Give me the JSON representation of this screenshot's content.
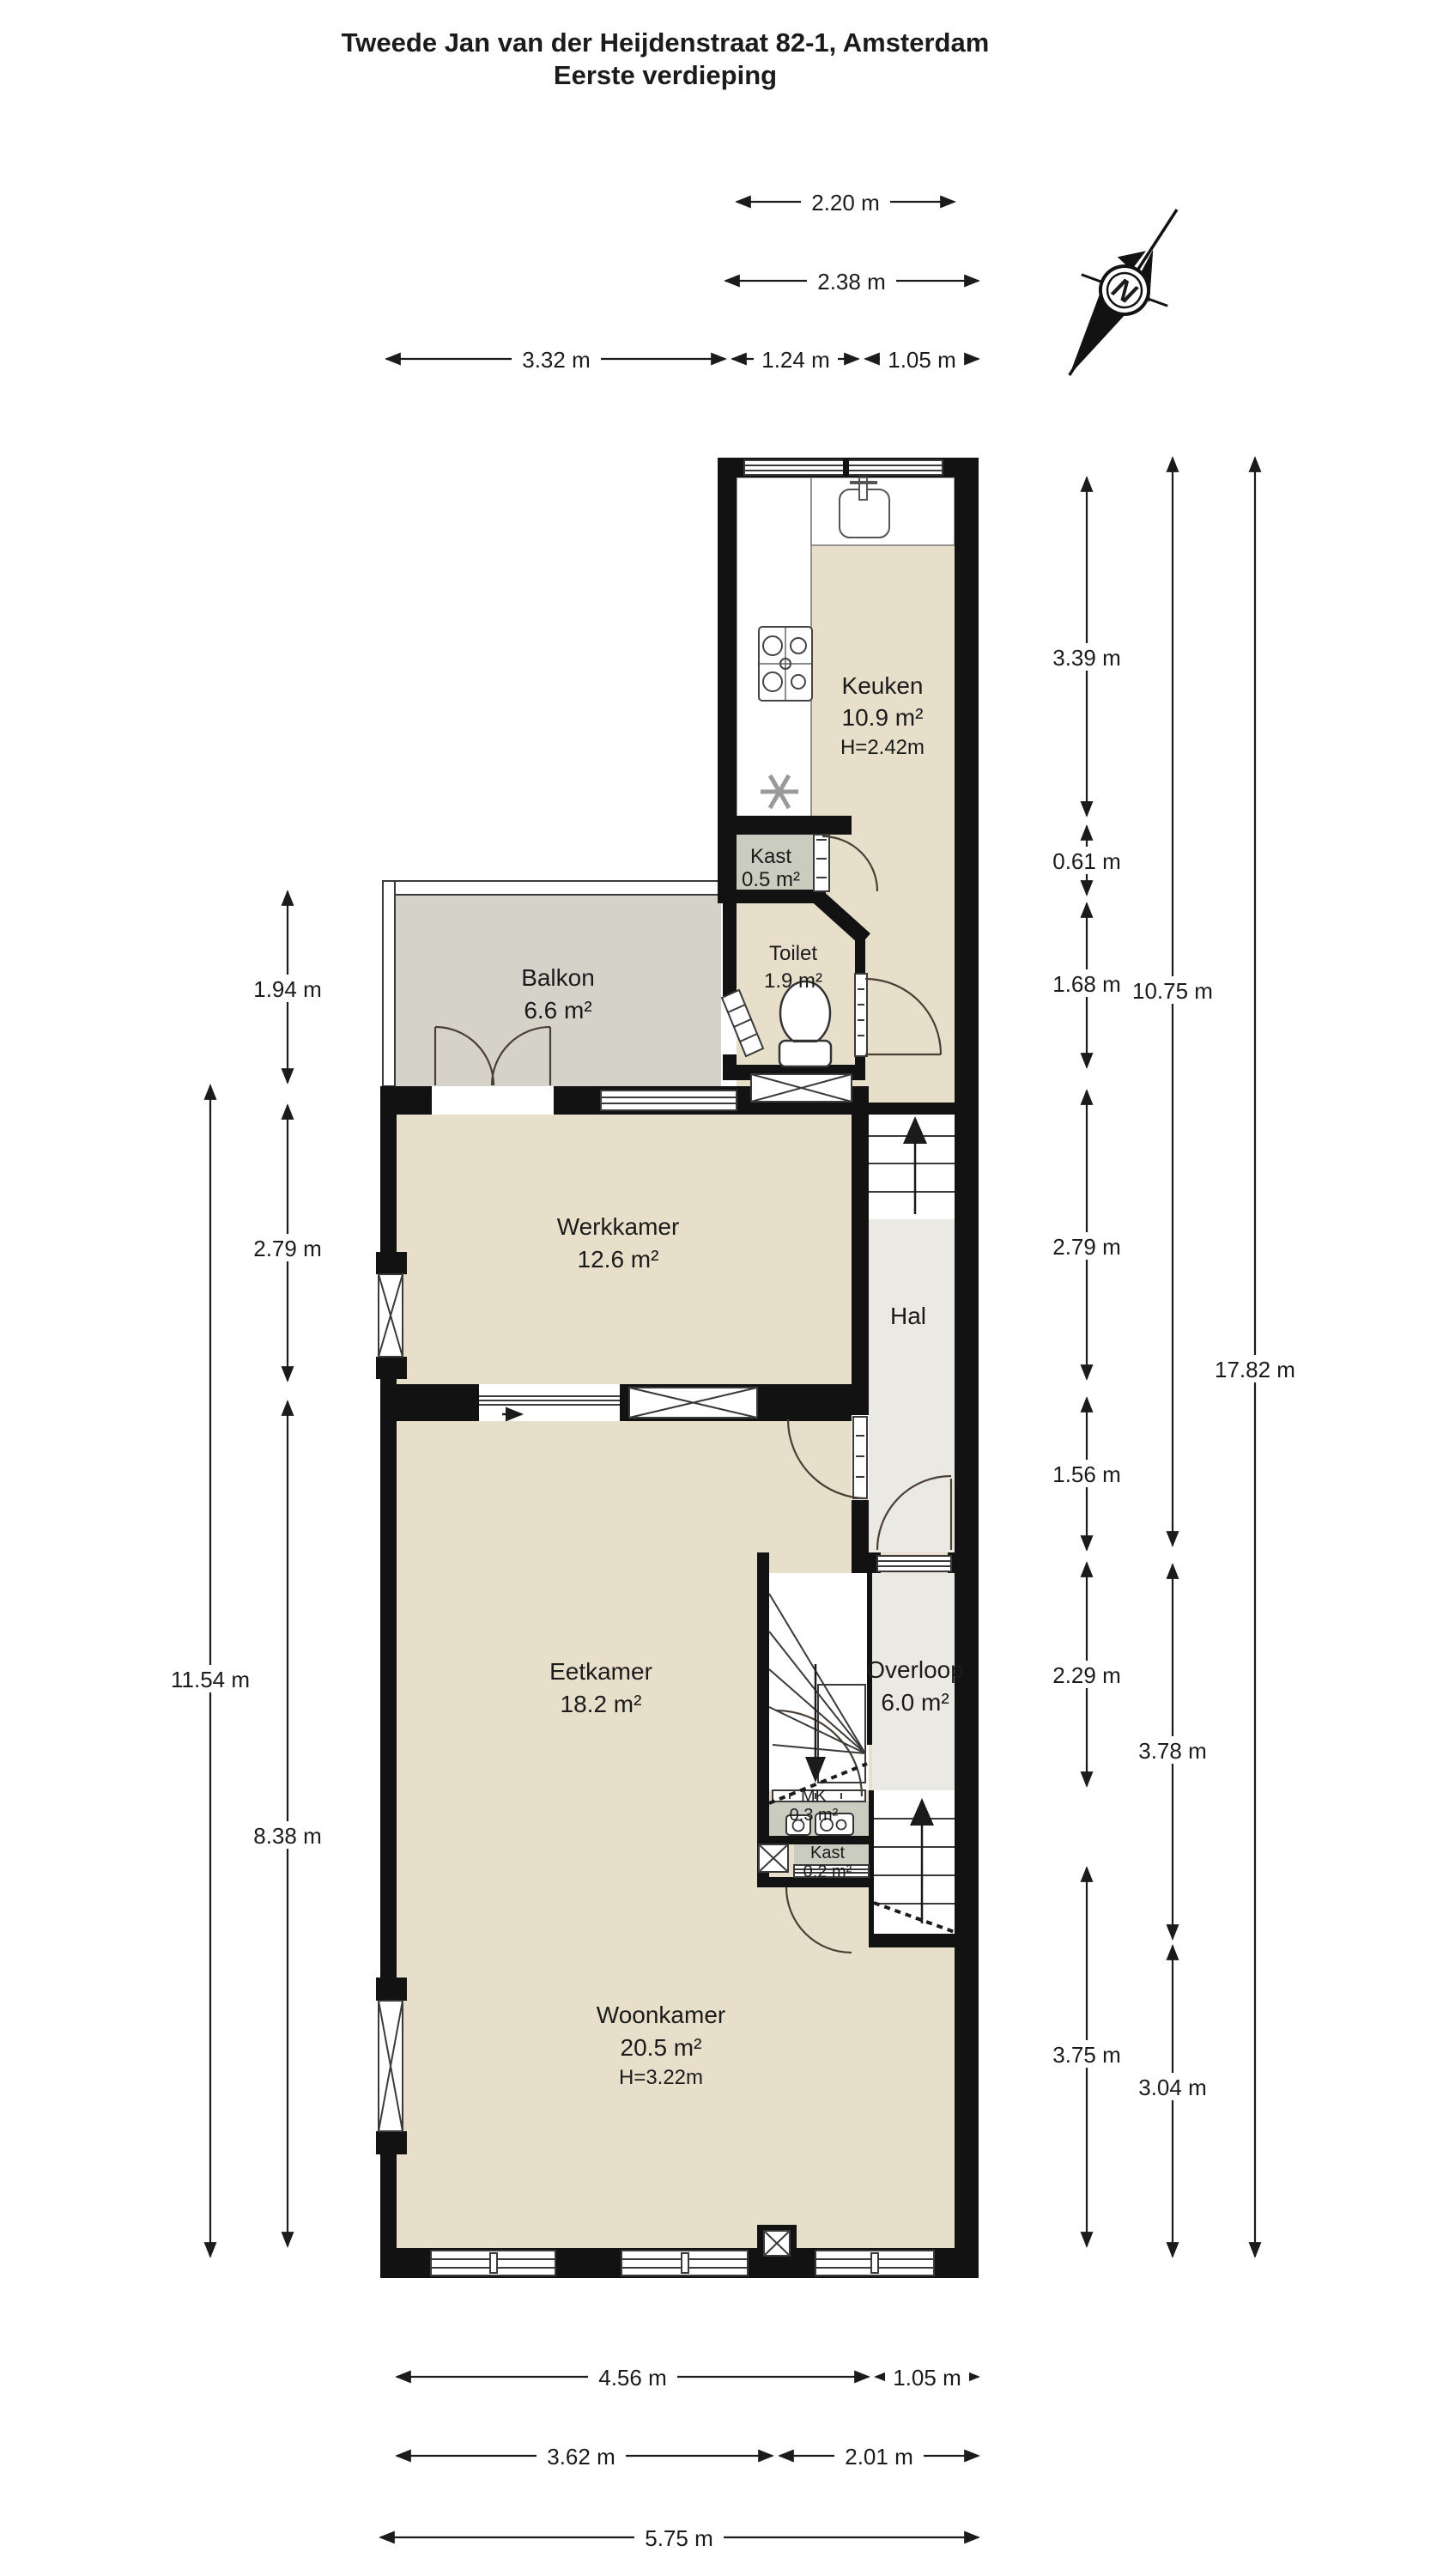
{
  "title": {
    "line1": "Tweede Jan van der Heijdenstraat 82-1, Amsterdam",
    "line2": "Eerste verdieping"
  },
  "compass": {
    "label": "N"
  },
  "rooms": {
    "keuken": {
      "name": "Keuken",
      "area": "10.9 m²",
      "height": "H=2.42m"
    },
    "kast_boven": {
      "name": "Kast",
      "area": "0.5 m²"
    },
    "toilet": {
      "name": "Toilet",
      "area": "1.9 m²"
    },
    "balkon": {
      "name": "Balkon",
      "area": "6.6 m²"
    },
    "werkkamer": {
      "name": "Werkkamer",
      "area": "12.6 m²"
    },
    "hal": {
      "name": "Hal"
    },
    "eetkamer": {
      "name": "Eetkamer",
      "area": "18.2 m²"
    },
    "overloop": {
      "name": "Overloop",
      "area": "6.0 m²"
    },
    "mk": {
      "name": "MK",
      "area": "0.3 m²"
    },
    "kast_klein": {
      "name": "Kast",
      "area": "0.2 m²"
    },
    "woonkamer": {
      "name": "Woonkamer",
      "area": "20.5 m²",
      "height": "H=3.22m"
    }
  },
  "dimensions": {
    "top": [
      {
        "label": "2.20 m"
      },
      {
        "label": "2.38 m"
      },
      {
        "label": "3.32 m"
      },
      {
        "label": "1.24 m"
      },
      {
        "label": "1.05 m"
      }
    ],
    "bottom": [
      {
        "label": "4.56 m"
      },
      {
        "label": "1.05 m"
      },
      {
        "label": "3.62 m"
      },
      {
        "label": "2.01 m"
      },
      {
        "label": "5.75 m"
      }
    ],
    "left": [
      {
        "label": "1.94 m"
      },
      {
        "label": "2.79 m"
      },
      {
        "label": "8.38 m"
      },
      {
        "label": "11.54 m"
      }
    ],
    "right": [
      {
        "label": "3.39 m"
      },
      {
        "label": "0.61 m"
      },
      {
        "label": "1.68 m"
      },
      {
        "label": "2.79 m"
      },
      {
        "label": "1.56 m"
      },
      {
        "label": "2.29 m"
      },
      {
        "label": "3.75 m"
      },
      {
        "label": "10.75 m"
      },
      {
        "label": "3.78 m"
      },
      {
        "label": "3.04 m"
      },
      {
        "label": "17.82 m"
      }
    ]
  },
  "colors": {
    "room_beige": "#e8dfcb",
    "balcony_gray": "#d5d2ca",
    "hall_gray": "#ebe9e3",
    "closet_green": "#c9ccbf",
    "wall_black": "#121212"
  }
}
